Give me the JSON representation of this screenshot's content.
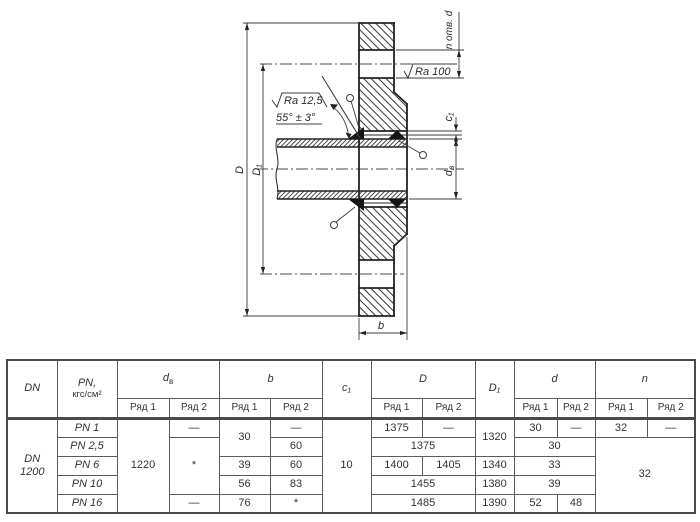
{
  "drawing": {
    "dim_D": "D",
    "dim_D1": "D₁",
    "dim_dv_base": "d",
    "dim_dv_sub": "в",
    "dim_c1": "c₁",
    "dim_b": "b",
    "holes_note": "n отв. d",
    "roughness_face": "Ra 100",
    "roughness_bevel": "Ra 12,5",
    "bevel_angle": "55° ± 3°"
  },
  "table": {
    "header": {
      "dn": "DN",
      "pn_line1": "PN,",
      "pn_line2": "кгс/см²",
      "dv_base": "d",
      "dv_sub": "в",
      "b": "b",
      "c1": "c₁",
      "D": "D",
      "D1": "D₁",
      "d": "d",
      "n": "n",
      "ryad1": "Ряд 1",
      "ryad2": "Ряд 2"
    },
    "shared": {
      "dn1": "DN",
      "dn2": "1200",
      "dv1": "1220",
      "c1": "10"
    },
    "rows": {
      "r1": {
        "pn": "PN 1",
        "dv2": "—",
        "b1": "30",
        "b2": "—",
        "D_r1": "1375",
        "D_r2": "—",
        "D1": "1320",
        "d_r1": "30",
        "d_r2": "—",
        "n_r1": "32",
        "n_r2": "—"
      },
      "r2": {
        "pn": "PN 2,5",
        "dv2": "*",
        "b2": "60",
        "D": "1375",
        "d": "30",
        "n": "32"
      },
      "r3": {
        "pn": "PN 6",
        "b1": "39",
        "b2": "60",
        "D_r1": "1400",
        "D_r2": "1405",
        "D1": "1340",
        "d": "33"
      },
      "r4": {
        "pn": "PN 10",
        "b1": "56",
        "b2": "83",
        "D": "1455",
        "D1": "1380",
        "d": "39"
      },
      "r5": {
        "pn": "PN 16",
        "dv2": "—",
        "b1": "76",
        "b2": "*",
        "D": "1485",
        "D1": "1390",
        "d_r1": "52",
        "d_r2": "48"
      }
    }
  }
}
